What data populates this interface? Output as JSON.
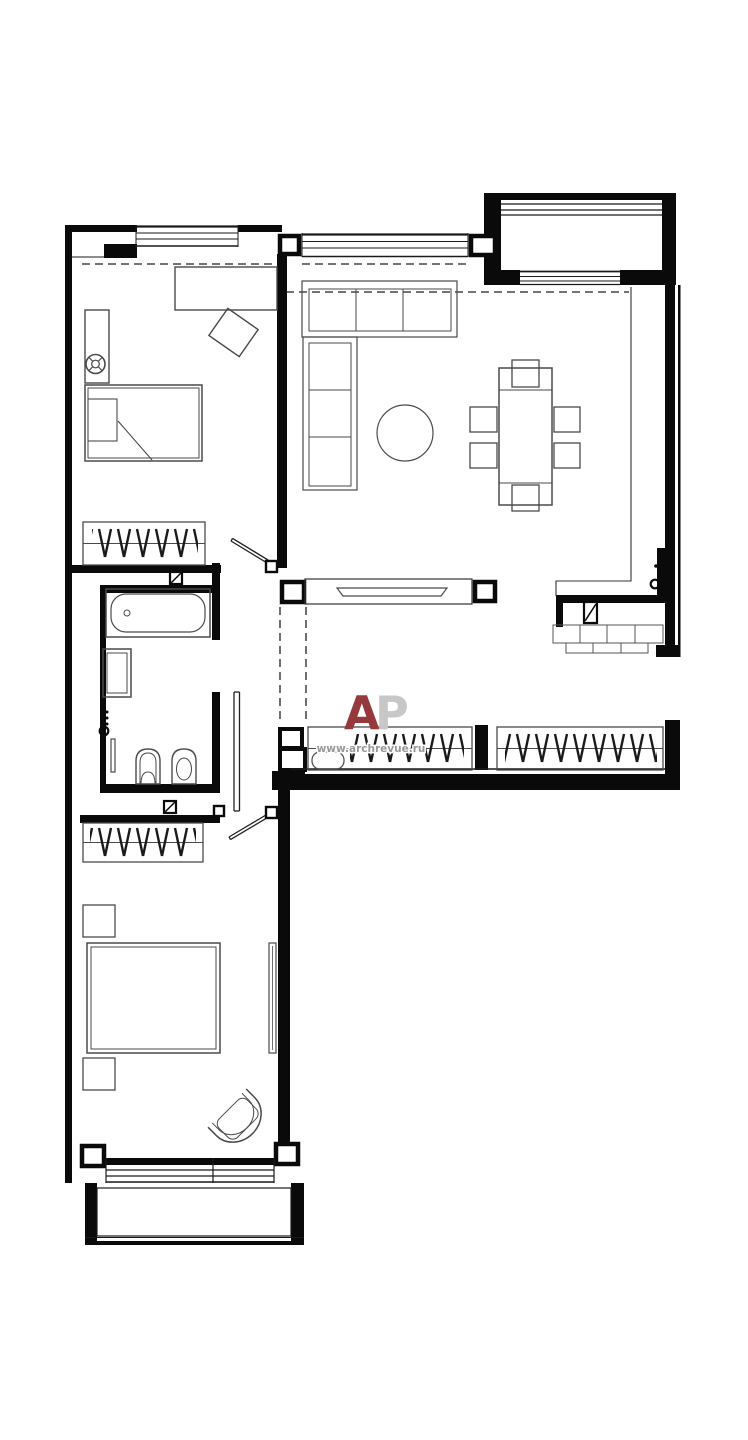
{
  "watermark": {
    "letter_a": "A",
    "letter_p": "P",
    "site_url": "www.archrevue.ru",
    "letter_a_color": "#96393c",
    "letter_p_color": "#c7c7c7",
    "url_color": "#999999"
  },
  "drawing": {
    "kind": "apartment floor plan, top view, black line work on white background",
    "wall_color": "#0a0a0a",
    "furniture_color": "#4a4a4a",
    "background_color": "#ffffff",
    "depicted_fixtures": [
      "single bed",
      "desk",
      "tilted desk chair",
      "round lamp symbol",
      "wardrobe with hanging-clothes symbol",
      "bathtub",
      "washing machine",
      "heated towel rail",
      "wall-hung toilet",
      "bidet",
      "corner sofa",
      "round coffee table",
      "dining table",
      "six dining chairs",
      "tv on media partition",
      "two built-in hallway wardrobes",
      "double bed",
      "two nightstands",
      "full-length mirror",
      "tub armchair",
      "upper balcony",
      "lower balcony",
      "duct symbols",
      "door swing leaves",
      "meter symbol with dots",
      "dashed ceiling lines"
    ]
  }
}
